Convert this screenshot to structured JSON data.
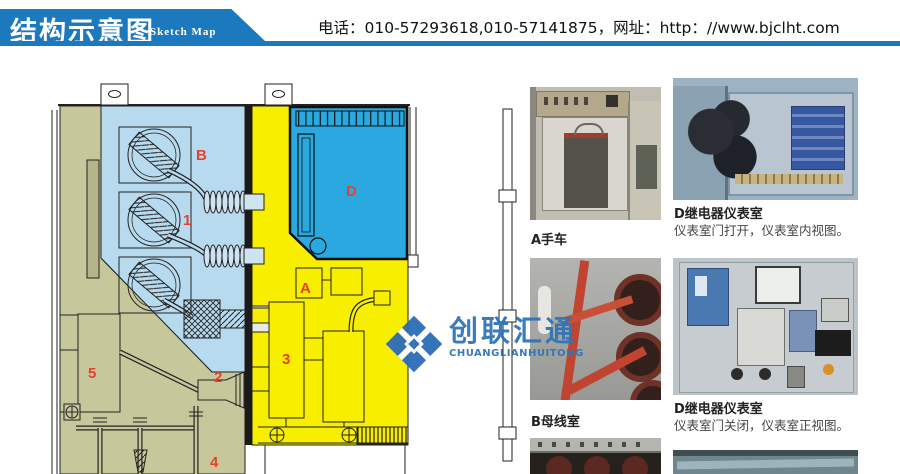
{
  "header": {
    "title": "结构示意图",
    "subtitle": "Sketch Map",
    "contact": "电话：010-57293618,010-57141875，网址：http：//www.bjclht.com"
  },
  "diagram": {
    "labels": [
      {
        "text": "B"
      },
      {
        "text": "1"
      },
      {
        "text": "D"
      },
      {
        "text": "A"
      },
      {
        "text": "3"
      },
      {
        "text": "2"
      },
      {
        "text": "5"
      },
      {
        "text": "4"
      }
    ],
    "watermark": {
      "cn": "创联汇通",
      "en": "CHUANGLIANHUITONG"
    }
  },
  "photos": {
    "a": {
      "caption": "A手车"
    },
    "d_open": {
      "title": "D继电器仪表室",
      "sub": "仪表室门打开，仪表室内视图。"
    },
    "b": {
      "caption": "B母线室"
    },
    "d_closed": {
      "title": "D继电器仪表室",
      "sub": "仪表室门关闭，仪表室正视图。"
    }
  },
  "colors": {
    "banner_blue": "#1d79be",
    "label_red": "#e8402f",
    "room_blue": "#b7daef",
    "room_cyan": "#2aa9e0",
    "room_yellow": "#f8ee00",
    "room_tan": "#c7c79c",
    "watermark_blue": "#2f74b8",
    "text_dark": "#222222"
  }
}
